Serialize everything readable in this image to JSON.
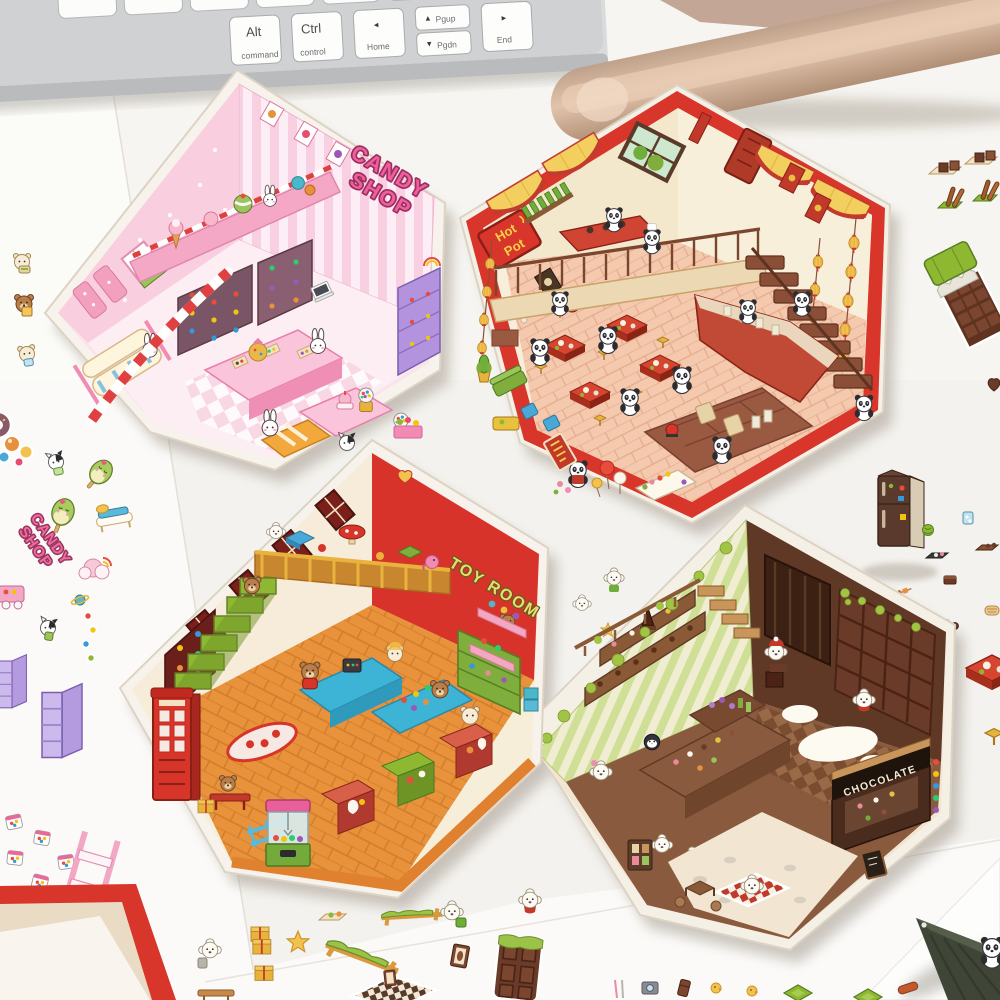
{
  "scene": {
    "setting": "Desk photo: four hexagonal miniature-room sticker panels with sticker sheets, keyboard and pen"
  },
  "keyboard": {
    "keys": {
      "alt": {
        "label": "Alt",
        "sublabel": "command"
      },
      "ctrl": {
        "label": "Ctrl",
        "sublabel": "control"
      },
      "home": {
        "arrow": "◂",
        "label": "Home"
      },
      "pgup": {
        "arrow": "▴",
        "label": "Pgup"
      },
      "pgdn": {
        "arrow": "▾",
        "label": "Pgdn"
      },
      "end": {
        "arrow": "▸",
        "label": "End"
      }
    }
  },
  "cards": {
    "candy_shop": {
      "title_line1": "CANDY",
      "title_line2": "SHOP"
    },
    "hot_pot": {
      "sign_line1": "Hot",
      "sign_line2": "Pot"
    },
    "toy_room": {
      "title": "TOY ROOM"
    },
    "chocolate_shop": {
      "sign": "CHOCOLATE"
    }
  },
  "sticker_sheets": {
    "candy_text_line1": "CANDY",
    "candy_text_line2": "SHOP"
  },
  "colors": {
    "desk": "#f4f2ee",
    "card_border_red": "#d8352b",
    "candy_pink": "#f9cfe0",
    "toy_red": "#d8332a",
    "hotpot_cream": "#f7eeda",
    "chocolate_brown": "#5f3826"
  }
}
